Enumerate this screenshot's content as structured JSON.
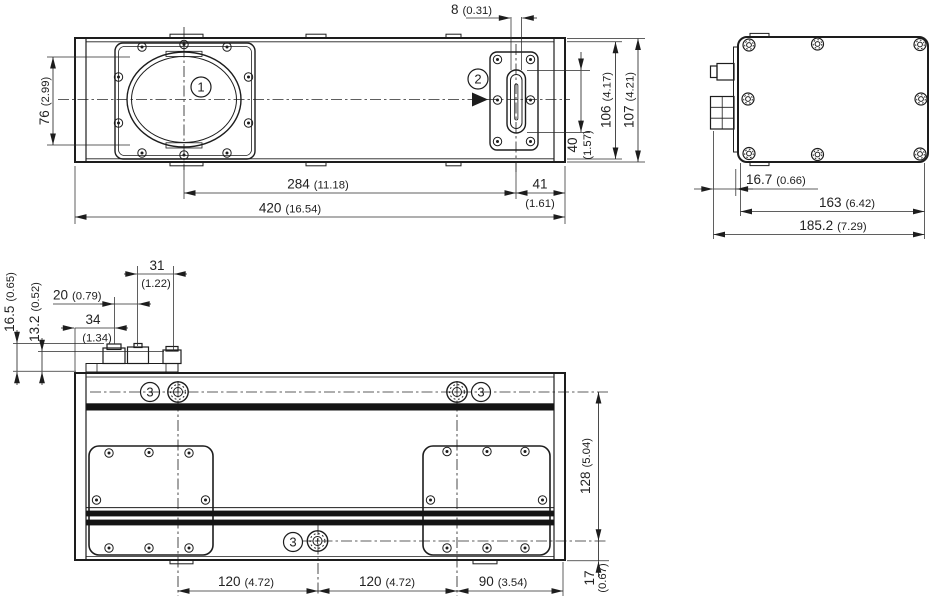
{
  "labels": {
    "window": "1",
    "emission": "2",
    "mount": "3"
  },
  "dims": {
    "front": {
      "slot_width": {
        "mm": "8",
        "inch": "(0.31)"
      },
      "lens_height": {
        "mm": "76",
        "inch": "(2.99)"
      },
      "hole_to_window": {
        "mm": "284",
        "inch": "(11.18)"
      },
      "window_to_end": {
        "mm": "41",
        "inch": "(1.61)"
      },
      "total_length": {
        "mm": "420",
        "inch": "(16.54)"
      },
      "slot_length": {
        "mm": "40",
        "inch": "(1.57)"
      },
      "height_inner": {
        "mm": "106",
        "inch": "(4.17)"
      },
      "height_total": {
        "mm": "107",
        "inch": "(4.21)"
      }
    },
    "side": {
      "connector_depth": {
        "mm": "16.7",
        "inch": "(0.66)"
      },
      "body_depth": {
        "mm": "163",
        "inch": "(6.42)"
      },
      "total_depth": {
        "mm": "185.2",
        "inch": "(7.29)"
      }
    },
    "bottom": {
      "conn1_offset": {
        "mm": "34",
        "inch": "(1.34)"
      },
      "conn2_offset": {
        "mm": "20",
        "inch": "(0.79)"
      },
      "conn3_offset": {
        "mm": "31",
        "inch": "(1.22)"
      },
      "conn_height1": {
        "mm": "16.5",
        "inch": "(0.65)"
      },
      "conn_height2": {
        "mm": "13.2",
        "inch": "(0.52)"
      },
      "hole_span1": {
        "mm": "120",
        "inch": "(4.72)"
      },
      "hole_span2": {
        "mm": "120",
        "inch": "(4.72)"
      },
      "hole_to_end": {
        "mm": "90",
        "inch": "(3.54)"
      },
      "hole_height": {
        "mm": "128",
        "inch": "(5.04)"
      },
      "hole_to_edge": {
        "mm": "17",
        "inch": "(0.67)"
      }
    }
  }
}
